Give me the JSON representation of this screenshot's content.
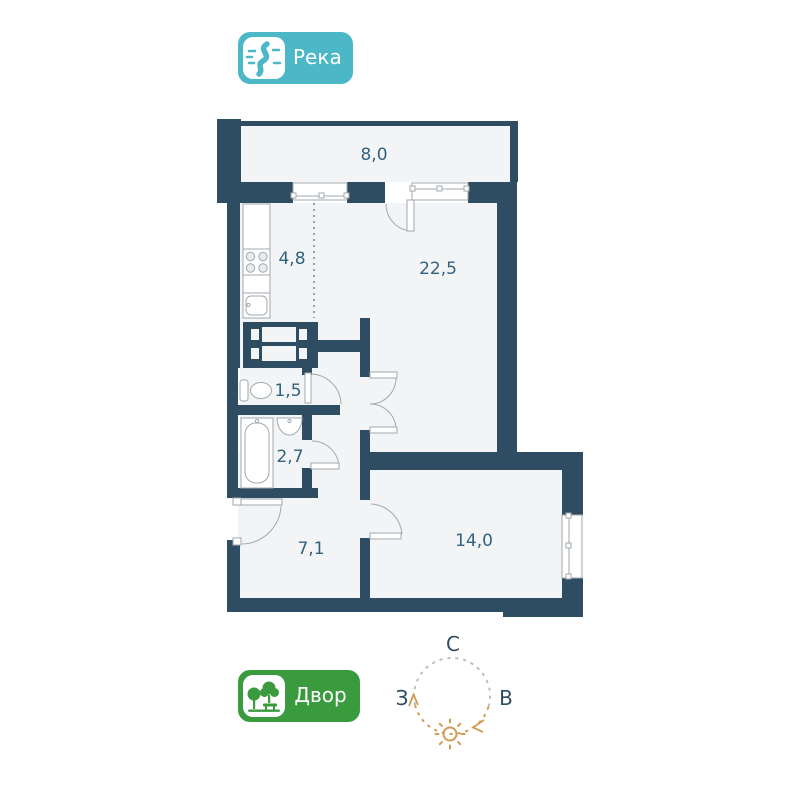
{
  "badges": {
    "river": {
      "label": "Река",
      "color": "#4cb7c6"
    },
    "yard": {
      "label": "Двор",
      "color": "#3a9a3e"
    }
  },
  "compass": {
    "north": "С",
    "west": "З",
    "east": "В",
    "sun_color": "#cf9c52"
  },
  "floorplan": {
    "wall_color": "#2e4d63",
    "floor_color": "#f2f4f5",
    "label_color": "#33627f",
    "rooms": [
      {
        "name": "balcony",
        "area": "8,0"
      },
      {
        "name": "kitchen",
        "area": "4,8"
      },
      {
        "name": "living-room",
        "area": "22,5"
      },
      {
        "name": "toilet",
        "area": "1,5"
      },
      {
        "name": "bathroom",
        "area": "2,7"
      },
      {
        "name": "hallway",
        "area": "7,1"
      },
      {
        "name": "bedroom",
        "area": "14,0"
      }
    ]
  }
}
